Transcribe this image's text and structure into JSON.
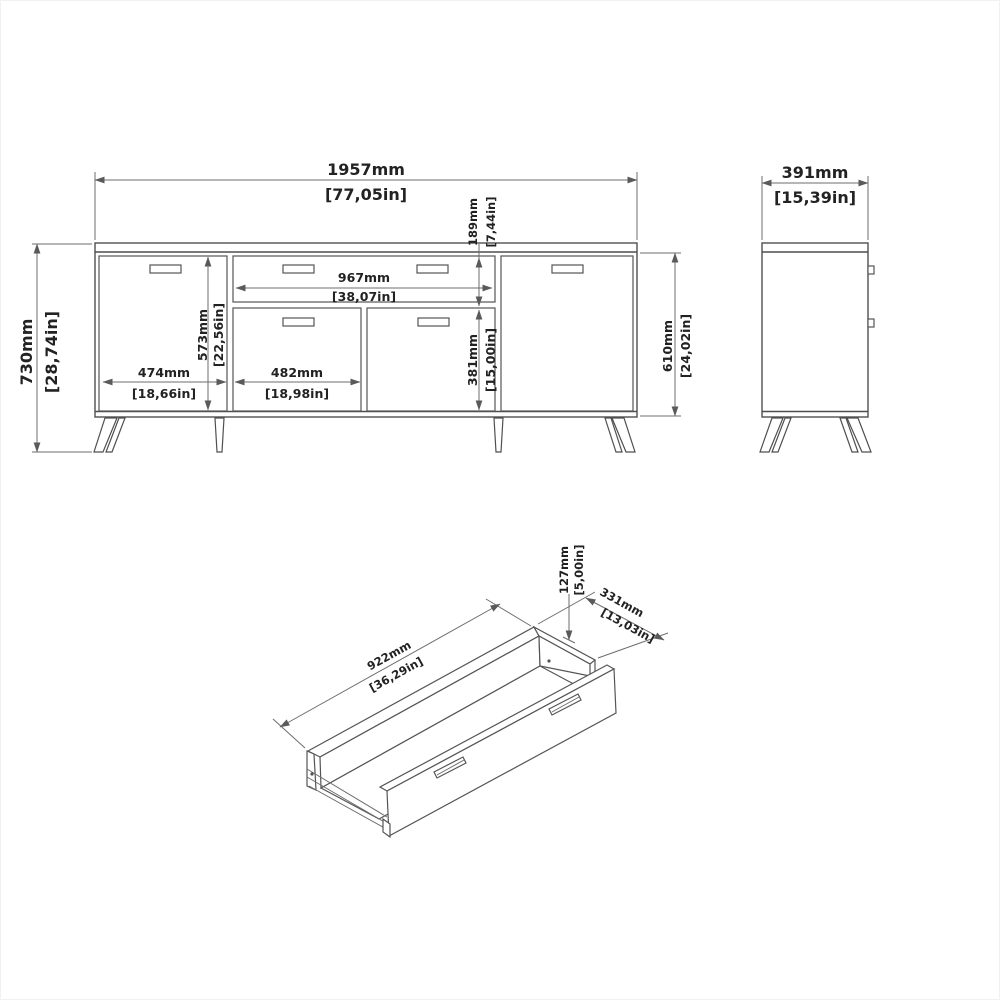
{
  "front_view": {
    "overall_width_mm": "1957mm",
    "overall_width_in": "[77,05in]",
    "overall_height_mm": "730mm",
    "overall_height_in": "[28,74in]",
    "top_drawer_height_mm": "189mm",
    "top_drawer_height_in": "[7,44in]",
    "drawer_width_mm": "967mm",
    "drawer_width_in": "[38,07in]",
    "carcass_inner_height_mm": "573mm",
    "carcass_inner_height_in": "[22,56in]",
    "left_door_width_mm": "474mm",
    "left_door_width_in": "[18,66in]",
    "center_door_width_mm": "482mm",
    "center_door_width_in": "[18,98in]",
    "lower_door_height_mm": "381mm",
    "lower_door_height_in": "[15,00in]",
    "body_height_mm": "610mm",
    "body_height_in": "[24,02in]"
  },
  "side_view": {
    "depth_mm": "391mm",
    "depth_in": "[15,39in]"
  },
  "drawer_view": {
    "inner_length_mm": "922mm",
    "inner_length_in": "[36,29in]",
    "inner_depth_mm": "331mm",
    "inner_depth_in": "[13,03in]",
    "inner_height_mm": "127mm",
    "inner_height_in": "[5,00in]"
  }
}
